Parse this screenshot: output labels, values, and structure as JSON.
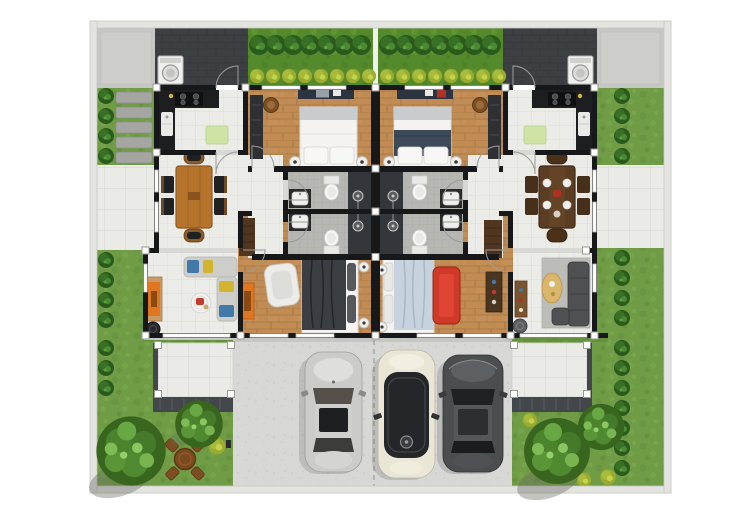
{
  "meta": {
    "title": "Duplex site plan, top-down architectural render",
    "kind": "floor-plan"
  },
  "scene": {
    "units": [
      "left-unit",
      "right-unit"
    ],
    "rooms_per_unit": [
      "kitchen",
      "front-bedroom",
      "bathroom-a",
      "bathroom-b",
      "dining-room",
      "living-room",
      "rear-bedroom"
    ],
    "outdoor": [
      "boundary-wall",
      "service-yard",
      "hedge-garden",
      "stepping-stones",
      "terrace",
      "patio",
      "lawn",
      "entry-porch",
      "driveway"
    ],
    "vehicles": [
      "silver-sedan",
      "cream-minivan",
      "charcoal-sedan"
    ],
    "landscape": [
      "trees",
      "shrub-rows",
      "fern-bushes",
      "outdoor-table-set"
    ]
  },
  "palette": {
    "page_bg": "#ffffff",
    "boundary_wall": "#e3e3df",
    "boundary_line": "#c7c7c3",
    "ground_base": "#d8d8d5",
    "grass": "#6f9c44",
    "garden_grass": "#558a2c",
    "tree_dark": "#39661f",
    "tree_mid": "#4c842d",
    "tree_light": "#79b450",
    "shrub": "#2b5a1d",
    "fern": "#9aab2f",
    "concrete": "#c6c6c3",
    "roof": "#3d4043",
    "driveway": "#d7d7d5",
    "paver": "#eaeae7",
    "tile": "#ebebe8",
    "wood": "#c18b54",
    "bath_tile": "#b6b7b3",
    "shower": "#33363a",
    "wall": "#17181a",
    "window": "#ffffff",
    "steps": "#43464a",
    "stone": "#a5a5a2",
    "table_wood": "#b5732c",
    "table_wood_dark": "#5a3d22",
    "chair_black": "#202124",
    "chair_brown": "#46301c",
    "sofa_light": "#cdcdc9",
    "sofa_dark": "#4e5052",
    "sofa_red": "#cf3a28",
    "cushion_blue": "#4179a8",
    "cushion_yellow": "#d2b42e",
    "rug": "#bcbcb8",
    "oval_table": "#d9b66c",
    "console_orange": "#e0761f",
    "wardrobe": "#2e3034",
    "shelf": "#503620",
    "desk": "#2c3440",
    "bed_white": "#f4f3f1",
    "duvet_navy": "#3e4a58",
    "duvet_dark": "#3b3e43",
    "duvet_blue": "#c6d3de",
    "fixture": "#f7f7f5",
    "vanity": "#27292b",
    "mat_green": "#cfe3a5",
    "car_silver": "#cbcbc9",
    "car_cream": "#eae6d6",
    "car_dark": "#4b4d4f",
    "glass_dark": "#24262a",
    "washer": "#efefed"
  }
}
